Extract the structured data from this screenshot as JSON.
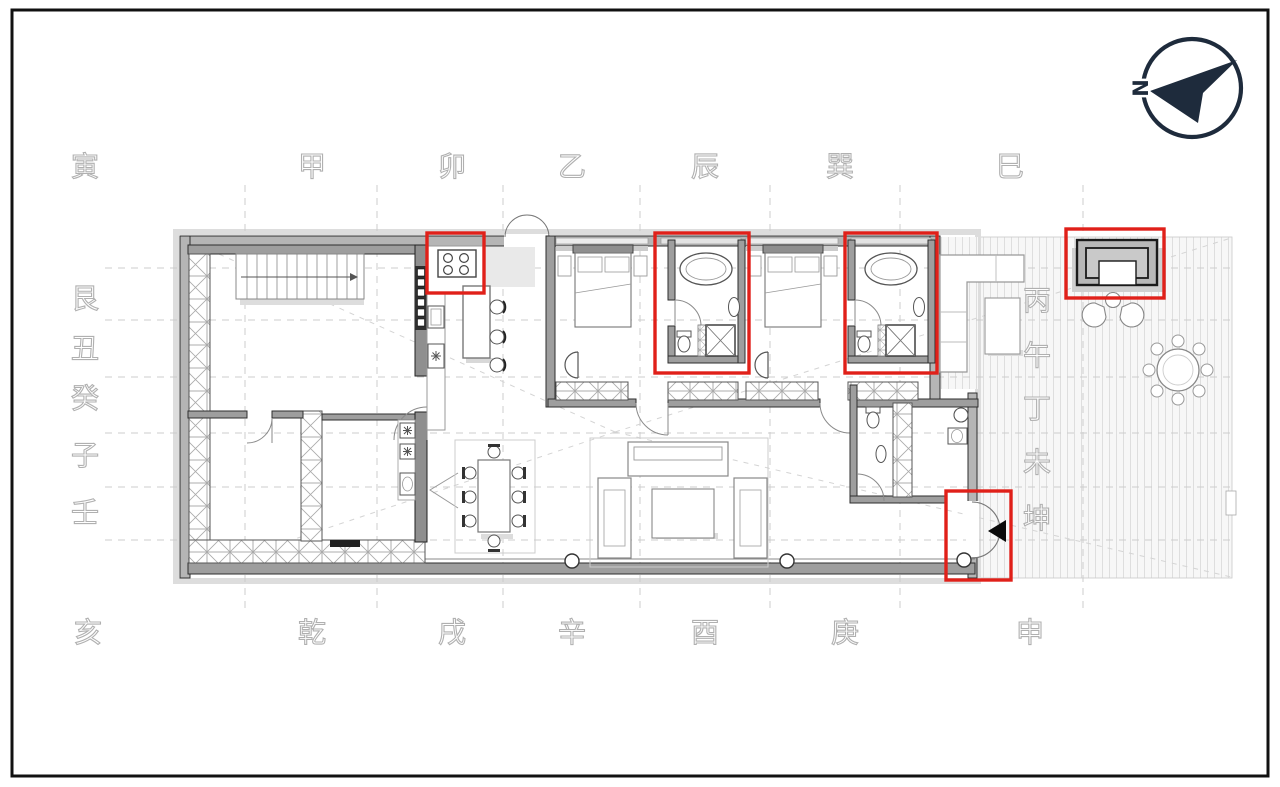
{
  "page": {
    "type": "architectural floor plan with feng shui 24-mountain compass overlay",
    "background": "#ffffff",
    "frame_color": "#111111"
  },
  "north_indicator": {
    "label": "N",
    "color": "#1e2b3c",
    "arrow_direction": "left"
  },
  "compass_ring": {
    "text_color": "#b0b0b0",
    "top": [
      "寅",
      "甲",
      "卯",
      "乙",
      "辰",
      "巽",
      "巳"
    ],
    "left": [
      "艮",
      "丑",
      "癸",
      "子",
      "壬"
    ],
    "right": [
      "丙",
      "午",
      "丁",
      "未",
      "坤"
    ],
    "bottom": [
      "亥",
      "乾",
      "戌",
      "辛",
      "酉",
      "庚",
      "申"
    ]
  },
  "highlights": {
    "color": "#e02019",
    "items": [
      "kitchen-stove",
      "ensuite-bathroom-1",
      "ensuite-bathroom-2",
      "entry-door",
      "outdoor-fireplace"
    ]
  },
  "plan": {
    "wall_fill": "#b5b5b5",
    "wall_edge": "#2e2e2e",
    "grid_color": "#cccccc",
    "deck_stripe": "#dedede",
    "furniture_line": "#888888"
  }
}
